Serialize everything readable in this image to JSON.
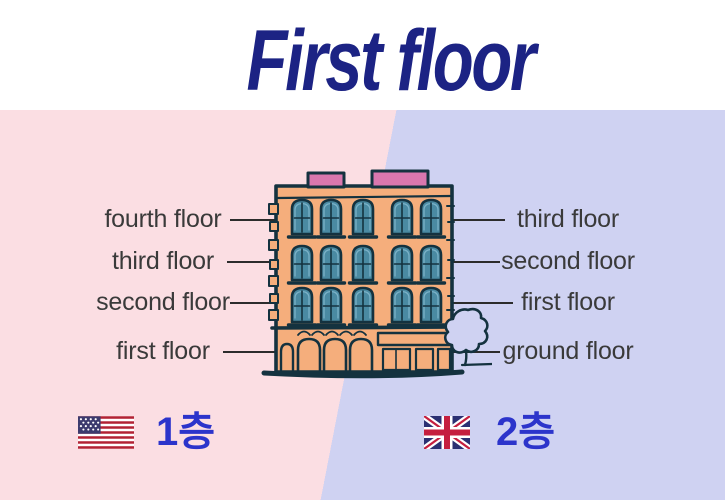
{
  "title": "First floor",
  "american_side": {
    "flag": "us-flag",
    "floor_labels": [
      "fourth floor",
      "third floor",
      "second floor",
      "first floor"
    ],
    "legend_label": "1층",
    "background_color": "#fbdee3"
  },
  "british_side": {
    "flag": "uk-flag",
    "floor_labels": [
      "third floor",
      "second floor",
      "first floor",
      "ground floor"
    ],
    "legend_label": "2층",
    "background_color": "#cfd2f2"
  },
  "colors": {
    "title_navy": "#1c2384",
    "label_text": "#3a3a3a",
    "legend_blue": "#2c34cb",
    "building_facade": "#f5ae7c",
    "building_outline": "#14323f",
    "window_teal": "#4a8aa2",
    "parapet_pink": "#d977ae"
  }
}
